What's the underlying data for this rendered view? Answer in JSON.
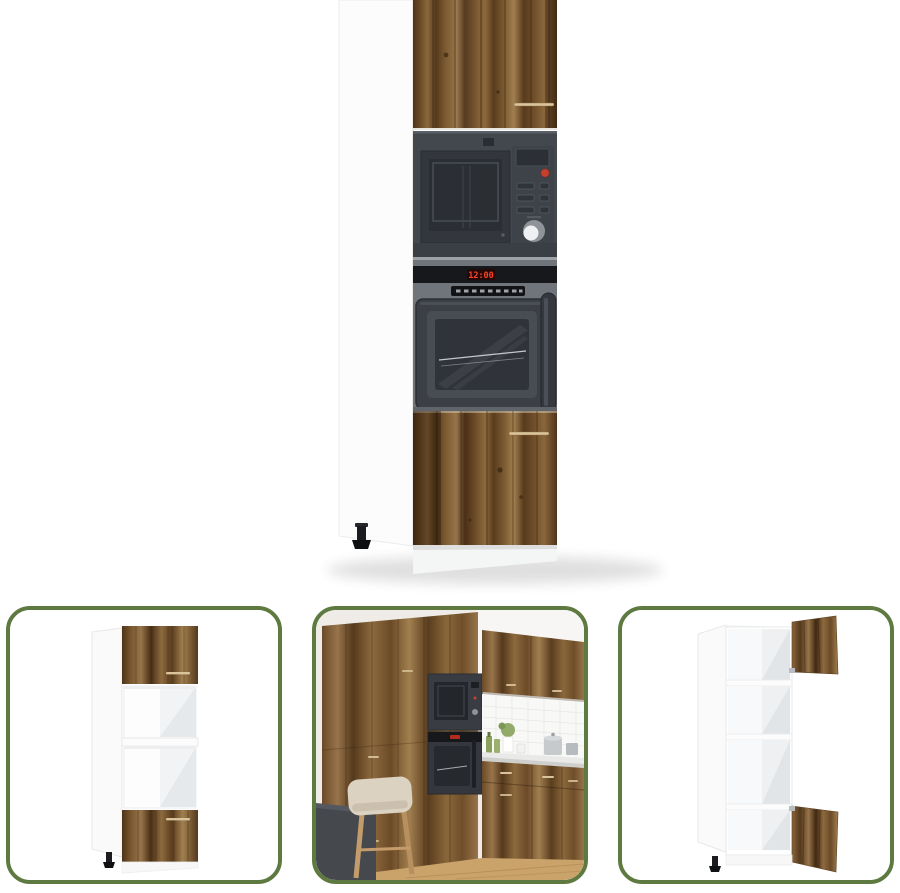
{
  "page": {
    "description": "Product image set of a tall kitchen cabinet in old-wood finish with built-in microwave and oven",
    "background": "#ffffff"
  },
  "main_image": {
    "name": "tall-kitchen-cabinet-with-built-in-microwave-and-oven",
    "oven_clock": "12:00",
    "colors": {
      "cabinet_white": "#fcfcfc",
      "wood_light": "#97744a",
      "wood_dark": "#4a2f15",
      "microwave_body": "#43474e",
      "oven_body": "#70747b",
      "display_red": "#ff4229",
      "handle_gold": "#d9c49b",
      "foot_black": "#17181b"
    }
  },
  "thumbnails": [
    {
      "id": "cabinet-angled-empty",
      "description": "Cabinet angled view with two open appliance niches and closed wood doors"
    },
    {
      "id": "kitchen-scene",
      "description": "Cabinet installed in a kitchen wall with microwave, oven, tiled backsplash, counter items, chair and table"
    },
    {
      "id": "cabinet-doors-open",
      "description": "Cabinet angled view with wooden doors open showing white interior compartments"
    }
  ],
  "frame": {
    "border_color": "#5e7a40",
    "corner_radius": 24
  }
}
